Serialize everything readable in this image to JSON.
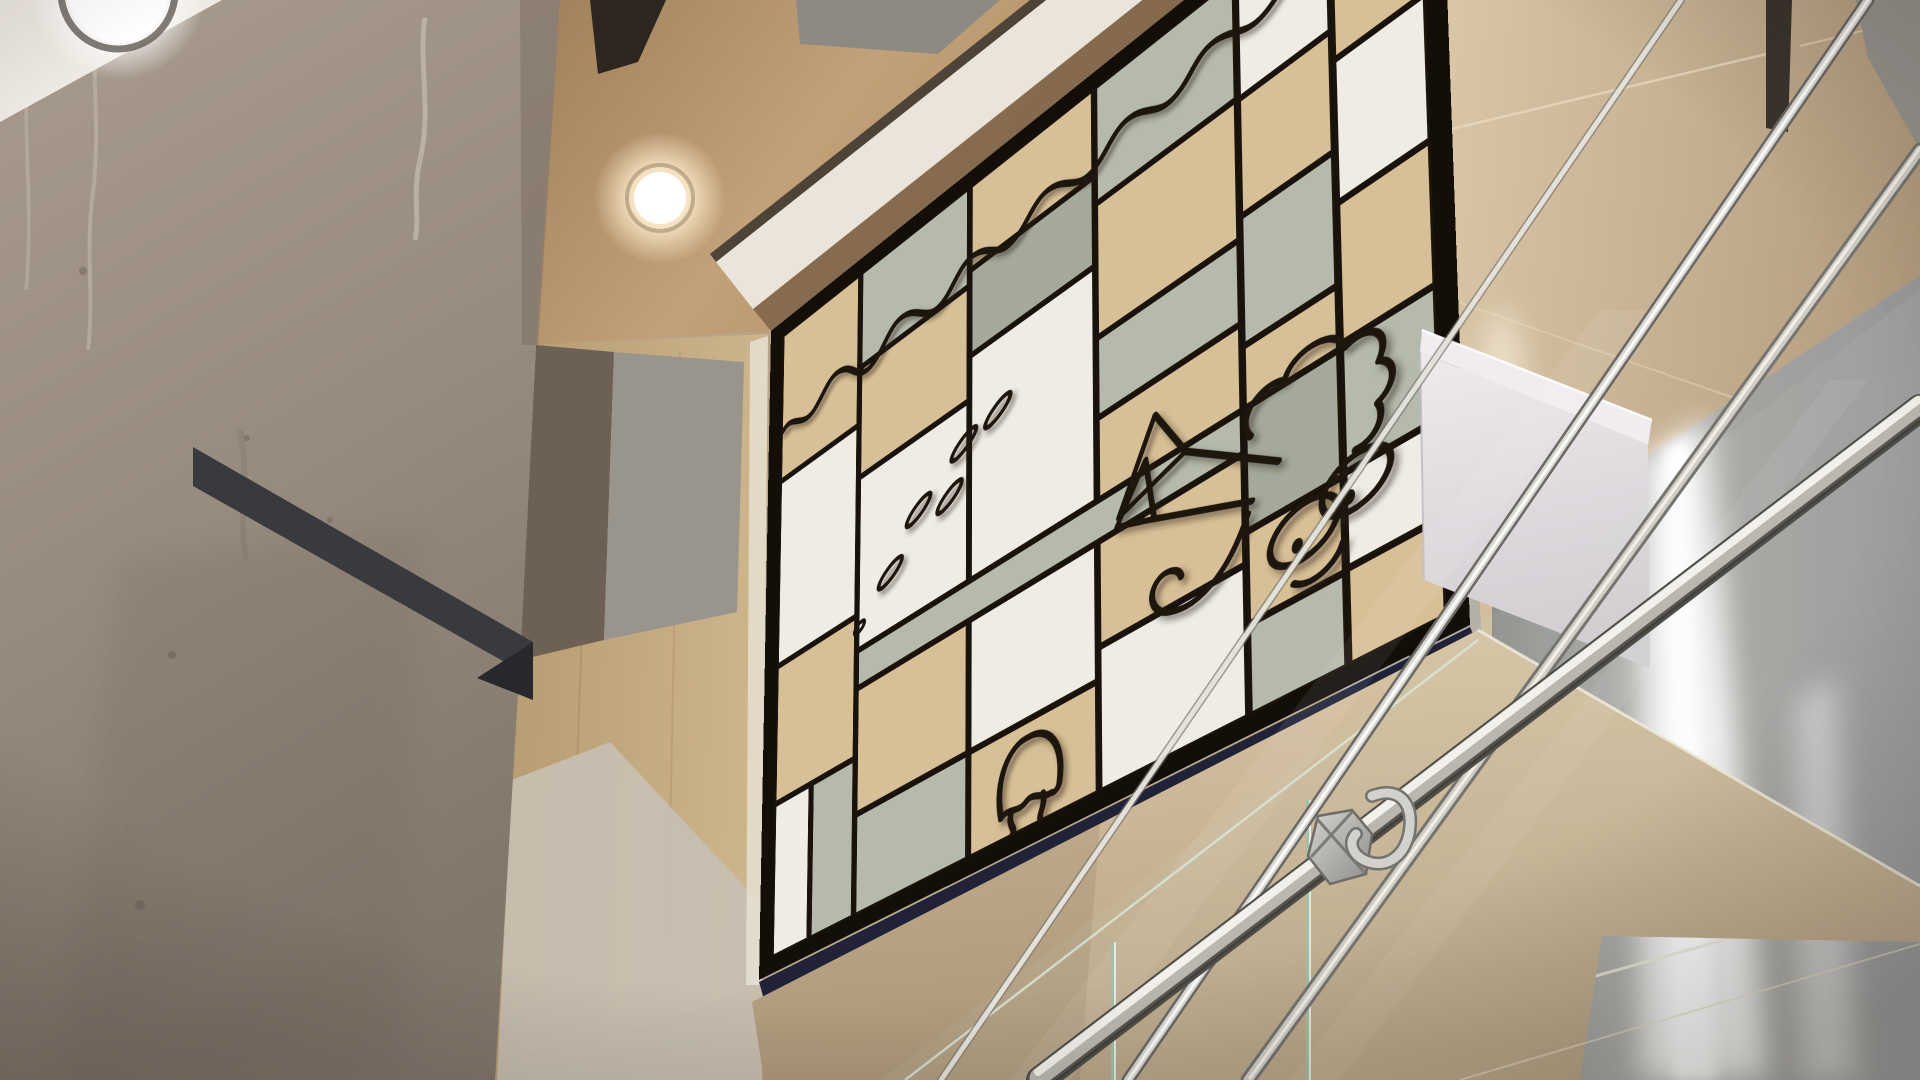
{
  "scene": {
    "type": "photograph",
    "setting": "low-angle view inside a building atrium stairwell",
    "elements": [
      "raw concrete column on the left",
      "white ceiling corner with round recessed light",
      "warm wood ceiling panel with second recessed downlight",
      "large tilted Mondrian-style wood marquetry artwork with cartoon sea creatures",
      "wood and metal wall panels on the right with vertical LED light coves",
      "glass stair balustrade with stainless steel handrails and bracket hook",
      "white box beam in front of the wall",
      "tan underside of stair flight"
    ]
  },
  "palette": {
    "concrete": "#9c9083",
    "concrete_dark": "#857a6e",
    "ceiling_white": "#eee9e2",
    "ceiling_wood": "#b8946c",
    "fascia_white": "#eae4da",
    "beam_dark": "#2d2621",
    "shadow_wall": "#6d6156",
    "gray_panel": "#99948c",
    "wall_wood": "#c3ab84",
    "wall_lightgray": "#c8c0b4",
    "wall_beige": "#cdb693",
    "reveal_dark": "#3b342c",
    "metal_panel": "#a3a19e",
    "squiggle_panel": "#b4b0a6",
    "navy_frame_depth": "#202238",
    "stair_tan": "#cdb794",
    "box_white": "#e3dee2",
    "box_top": "#f0ecef",
    "rail_metal": "#c9c7c0",
    "glass_edge": "#cfe3d4"
  },
  "artwork": {
    "style": "Mondrian-style marquetry grid with cartoon squid, jellyfish, eggs and water line",
    "background_line_color": "#1a120c",
    "frame_color": "#140e09",
    "panel_colors": {
      "wood": "#d8c096",
      "sage": "#b5baac",
      "sage_dark": "#a4a99b",
      "white": "#efece5"
    },
    "grid": [
      {
        "x": 20,
        "y": 20,
        "w": 102,
        "h": 166,
        "c": "wood"
      },
      {
        "x": 20,
        "y": 193,
        "w": 102,
        "h": 205,
        "c": "white"
      },
      {
        "x": 20,
        "y": 405,
        "w": 102,
        "h": 147,
        "c": "wood"
      },
      {
        "x": 20,
        "y": 559,
        "w": 44,
        "h": 161,
        "c": "white"
      },
      {
        "x": 71,
        "y": 559,
        "w": 51,
        "h": 161,
        "c": "sage"
      },
      {
        "x": 129,
        "y": 20,
        "w": 132,
        "h": 102,
        "c": "sage"
      },
      {
        "x": 129,
        "y": 129,
        "w": 132,
        "h": 117,
        "c": "wood"
      },
      {
        "x": 129,
        "y": 253,
        "w": 132,
        "h": 184,
        "c": "white"
      },
      {
        "x": 129,
        "y": 485,
        "w": 132,
        "h": 128,
        "c": "wood"
      },
      {
        "x": 129,
        "y": 620,
        "w": 132,
        "h": 100,
        "c": "sage"
      },
      {
        "x": 268,
        "y": 20,
        "w": 136,
        "h": 86,
        "c": "wood"
      },
      {
        "x": 268,
        "y": 113,
        "w": 136,
        "h": 86,
        "c": "sage_dark"
      },
      {
        "x": 268,
        "y": 206,
        "w": 136,
        "h": 231,
        "c": "white"
      },
      {
        "x": 268,
        "y": 485,
        "w": 136,
        "h": 128,
        "c": "white"
      },
      {
        "x": 268,
        "y": 620,
        "w": 136,
        "h": 100,
        "c": "wood"
      },
      {
        "x": 129,
        "y": 444,
        "w": 421,
        "h": 34,
        "c": "sage"
      },
      {
        "x": 411,
        "y": 20,
        "w": 139,
        "h": 116,
        "c": "sage"
      },
      {
        "x": 411,
        "y": 143,
        "w": 139,
        "h": 131,
        "c": "wood"
      },
      {
        "x": 411,
        "y": 281,
        "w": 139,
        "h": 74,
        "c": "sage"
      },
      {
        "x": 411,
        "y": 362,
        "w": 139,
        "h": 75,
        "c": "wood"
      },
      {
        "x": 411,
        "y": 485,
        "w": 139,
        "h": 96,
        "c": "wood"
      },
      {
        "x": 411,
        "y": 588,
        "w": 139,
        "h": 132,
        "c": "white"
      },
      {
        "x": 557,
        "y": 20,
        "w": 81,
        "h": 118,
        "c": "white"
      },
      {
        "x": 557,
        "y": 145,
        "w": 81,
        "h": 108,
        "c": "wood"
      },
      {
        "x": 557,
        "y": 260,
        "w": 81,
        "h": 118,
        "c": "sage"
      },
      {
        "x": 557,
        "y": 385,
        "w": 81,
        "h": 52,
        "c": "wood"
      },
      {
        "x": 557,
        "y": 444,
        "w": 81,
        "h": 108,
        "c": "sage_dark"
      },
      {
        "x": 557,
        "y": 559,
        "w": 81,
        "h": 78,
        "c": "wood"
      },
      {
        "x": 557,
        "y": 644,
        "w": 81,
        "h": 76,
        "c": "sage"
      },
      {
        "x": 645,
        "y": 20,
        "w": 75,
        "h": 148,
        "c": "wood"
      },
      {
        "x": 645,
        "y": 175,
        "w": 75,
        "h": 128,
        "c": "white"
      },
      {
        "x": 645,
        "y": 310,
        "w": 75,
        "h": 123,
        "c": "wood"
      },
      {
        "x": 645,
        "y": 440,
        "w": 75,
        "h": 110,
        "c": "sage"
      },
      {
        "x": 645,
        "y": 557,
        "w": 75,
        "h": 78,
        "c": "white"
      },
      {
        "x": 645,
        "y": 642,
        "w": 75,
        "h": 78,
        "c": "wood"
      }
    ],
    "characters": [
      {
        "name": "water-wave-line"
      },
      {
        "name": "egg-cluster",
        "count": 5,
        "centers": [
          [
            258,
            292
          ],
          [
            298,
            281
          ],
          [
            203,
            330
          ],
          [
            241,
            338
          ],
          [
            168,
            378
          ]
        ],
        "rx": 17,
        "ry": 6.5,
        "rotation": -33
      },
      {
        "name": "squid-with-eyes"
      },
      {
        "name": "jellyfish"
      }
    ],
    "wall_squiggle": {
      "name": "ink-squiggle-on-gray-panel"
    }
  },
  "lights": {
    "recessed_downlights": 2,
    "led_wall_strips": 2
  }
}
